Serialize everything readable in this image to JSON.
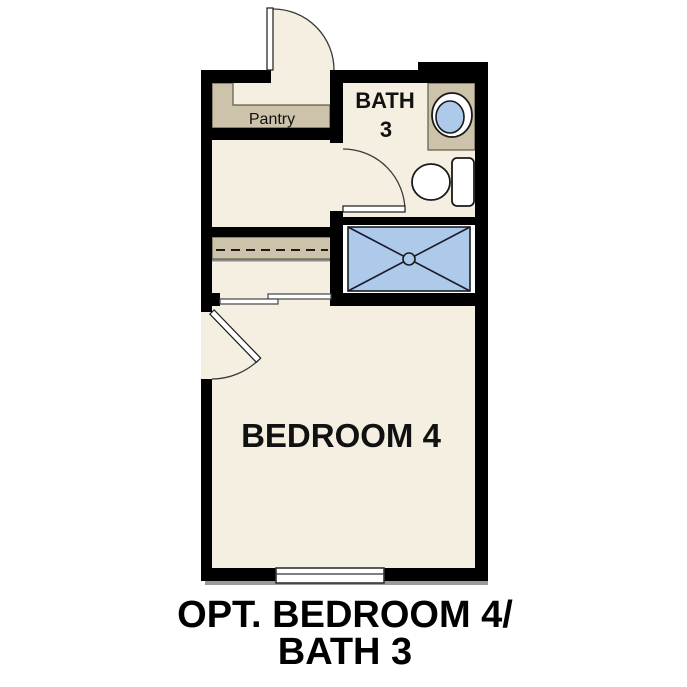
{
  "title": "Optional Bedroom 4 / Bath 3 floor plan",
  "labels": {
    "pantry": "Pantry",
    "bath_line1": "BATH",
    "bath_line2": "3",
    "bedroom": "BEDROOM 4"
  },
  "caption": {
    "line1": "OPT. BEDROOM 4/",
    "line2": "BATH 3"
  },
  "fixtures": [
    "sink",
    "toilet",
    "shower-pan-with-drain",
    "closet-rod",
    "pantry-shelves",
    "vanity-counter",
    "window",
    "swing-door-top",
    "swing-door-bath",
    "swing-door-bedroom",
    "bypass-closet-doors"
  ],
  "colors": {
    "background": "#ffffff",
    "wall": "#000000",
    "floor": "#f5efe2",
    "counter_tan": "#cdc2aa",
    "fixture_blue": "#adcaea",
    "outline": "#1a1a1a",
    "shadow": "#9a9a9a",
    "text": "#111111"
  }
}
